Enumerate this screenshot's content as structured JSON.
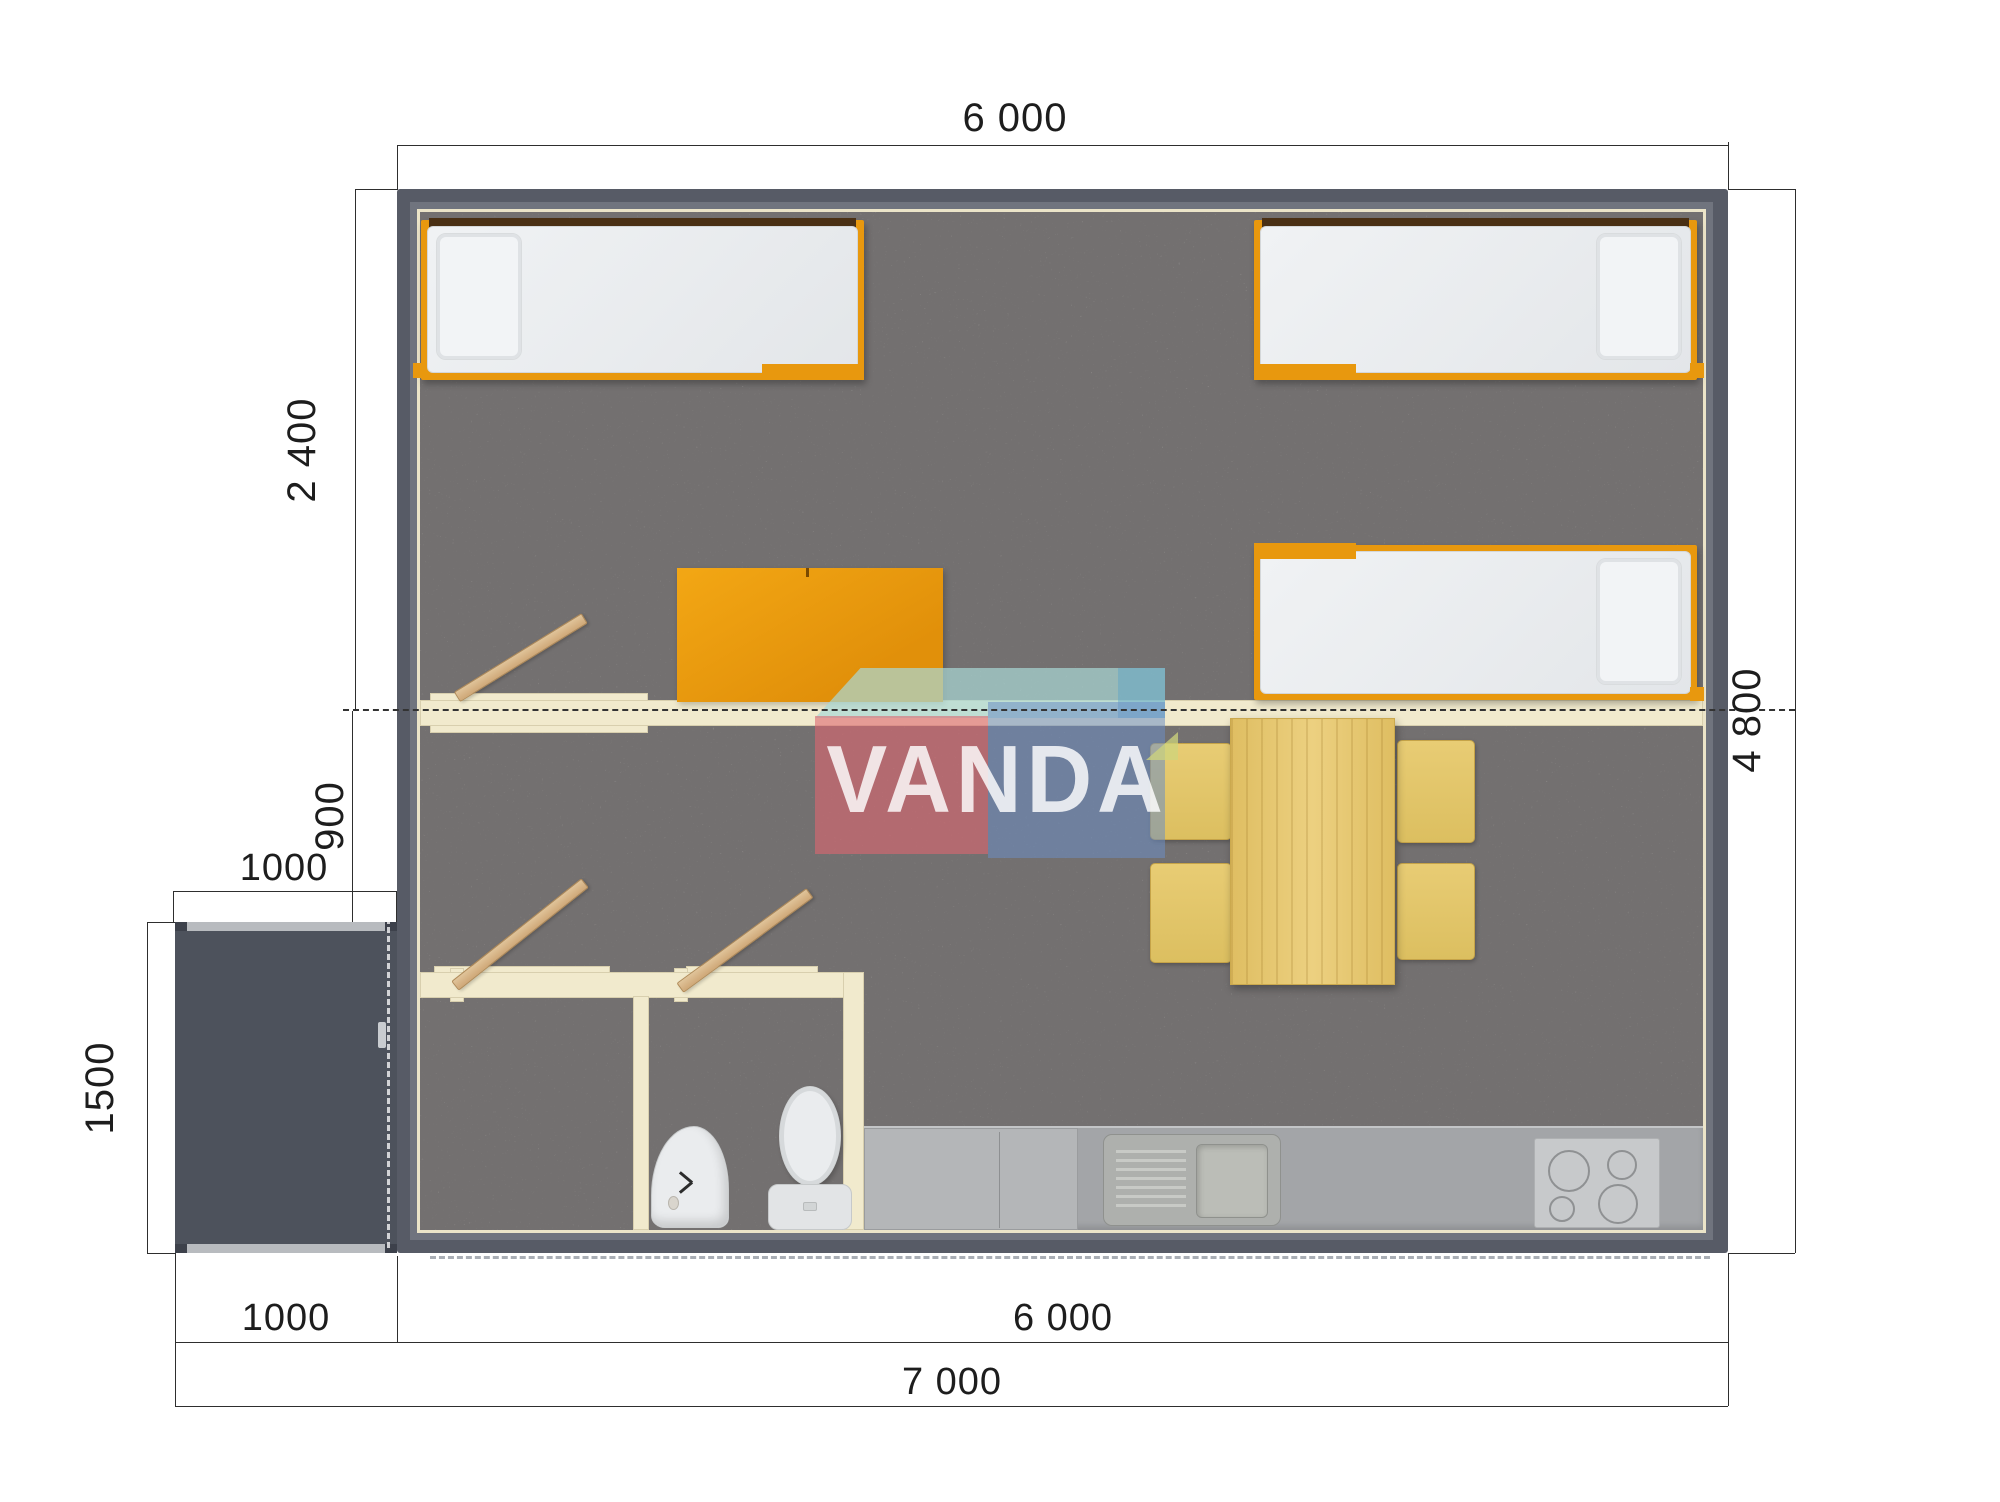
{
  "title": "floor-plan",
  "watermark": {
    "brand": "VANDA"
  },
  "dimensions": {
    "top_width": "6 000",
    "left_bedroom_depth": "2 400",
    "left_living_depth": "900",
    "porch_width": "1000",
    "porch_depth": "1500",
    "right_total_depth": "4 800",
    "bottom_porch_width": "1000",
    "bottom_main_width": "6 000",
    "bottom_total_width": "7 000"
  },
  "colors": {
    "wall": "#575b66",
    "porch": "#4d525c",
    "floor_carpet": "#aba7a6",
    "partition_cream": "#f1eacd",
    "accent_orange": "#e8980e",
    "door_wood": "#d9b98c",
    "table_wood": "#e6c873",
    "chair": "#e3c76b",
    "counter_gray": "#a3a5a8",
    "watermark_pink": "#de6670",
    "watermark_blue": "#6c8ec4",
    "watermark_teal": "#aad8d6",
    "dimension_line": "#2e2e2e"
  }
}
